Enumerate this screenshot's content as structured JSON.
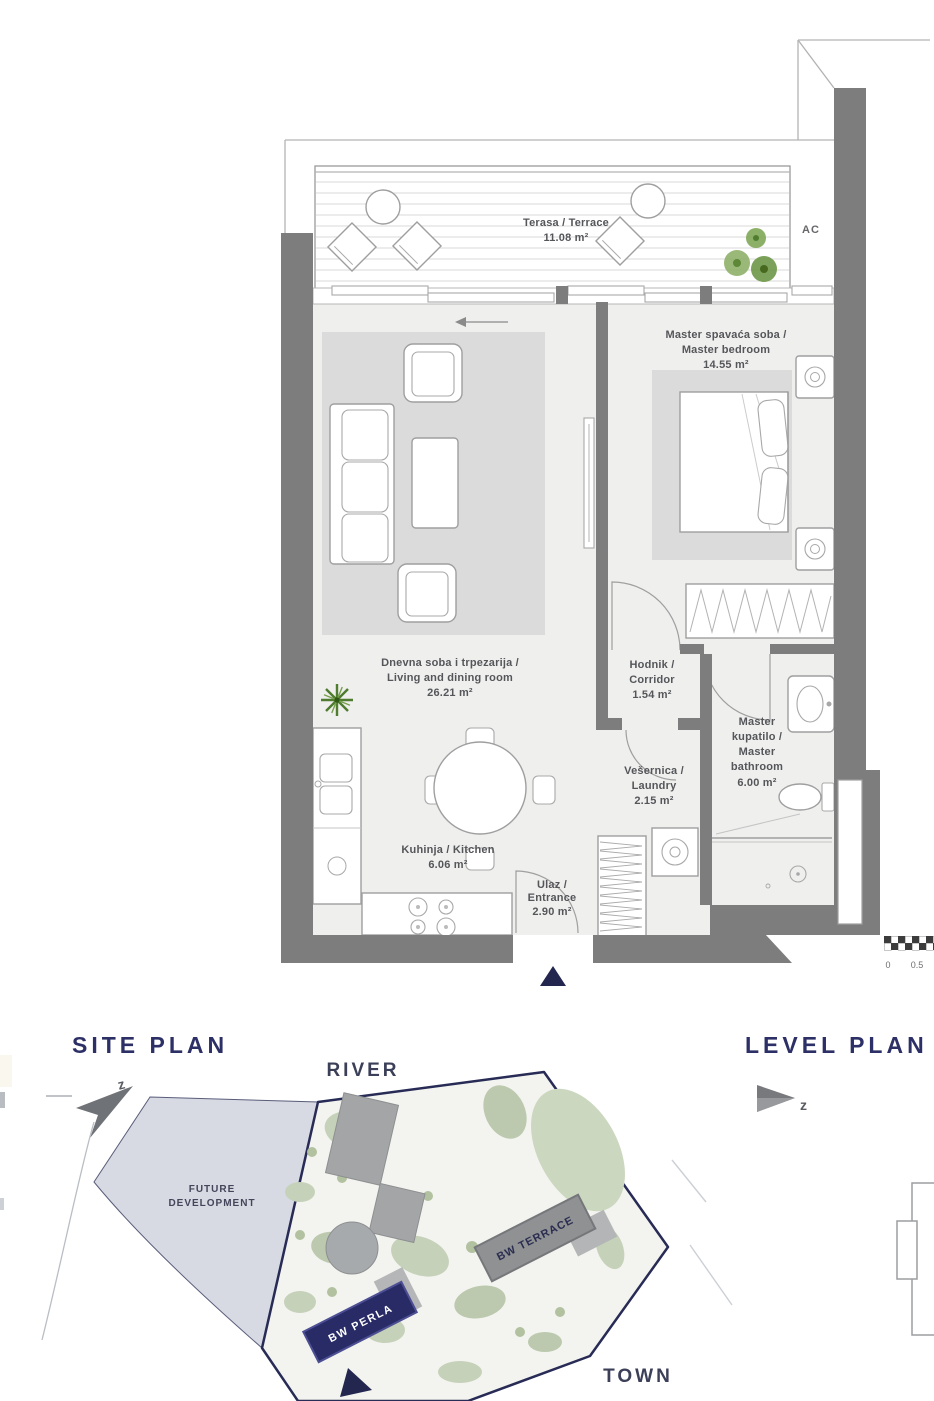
{
  "floor_plan": {
    "ac_label": "AC",
    "rooms": {
      "terrace": {
        "name": "Terasa / Terrace",
        "area": "11.08 m²"
      },
      "master_bedroom": {
        "name_line1": "Master spavaća soba /",
        "name_line2": "Master bedroom",
        "area": "14.55 m²"
      },
      "living_dining": {
        "name_line1": "Dnevna soba i trpezarija /",
        "name_line2": "Living and dining room",
        "area": "26.21 m²"
      },
      "corridor": {
        "name_line1": "Hodnik /",
        "name_line2": "Corridor",
        "area": "1.54 m²"
      },
      "laundry": {
        "name_line1": "Vešernica /",
        "name_line2": "Laundry",
        "area": "2.15 m²"
      },
      "master_bathroom": {
        "name_line1": "Master",
        "name_line2": "kupatilo /",
        "name_line3": "Master",
        "name_line4": "bathroom",
        "area": "6.00 m²"
      },
      "kitchen": {
        "name": "Kuhinja / Kitchen",
        "area": "6.06 m²"
      },
      "entrance": {
        "name_line1": "Ulaz /",
        "name_line2": "Entrance",
        "area": "2.90 m²"
      }
    },
    "scale_bar": {
      "label_start": "0",
      "label_mid": "0.5"
    }
  },
  "site_plan": {
    "title": "SITE PLAN",
    "river_label": "RIVER",
    "town_label": "TOWN",
    "future_development_line1": "FUTURE",
    "future_development_line2": "DEVELOPMENT",
    "building_terrace_label": "BW TERRACE",
    "building_perla_label": "BW PERLA",
    "north_label": "z"
  },
  "level_plan": {
    "title": "LEVEL PLAN",
    "north_label": "z"
  },
  "colors": {
    "wall_gray": "#7d7d7d",
    "floor_gray": "#efefee",
    "rug_gray": "#dbdbdb",
    "navy": "#2d3066",
    "parcel_lavender": "#d8dae3",
    "landscape_green": "#c6d1b9",
    "plant_green": "#76a04c",
    "label_text": "#55565a"
  }
}
